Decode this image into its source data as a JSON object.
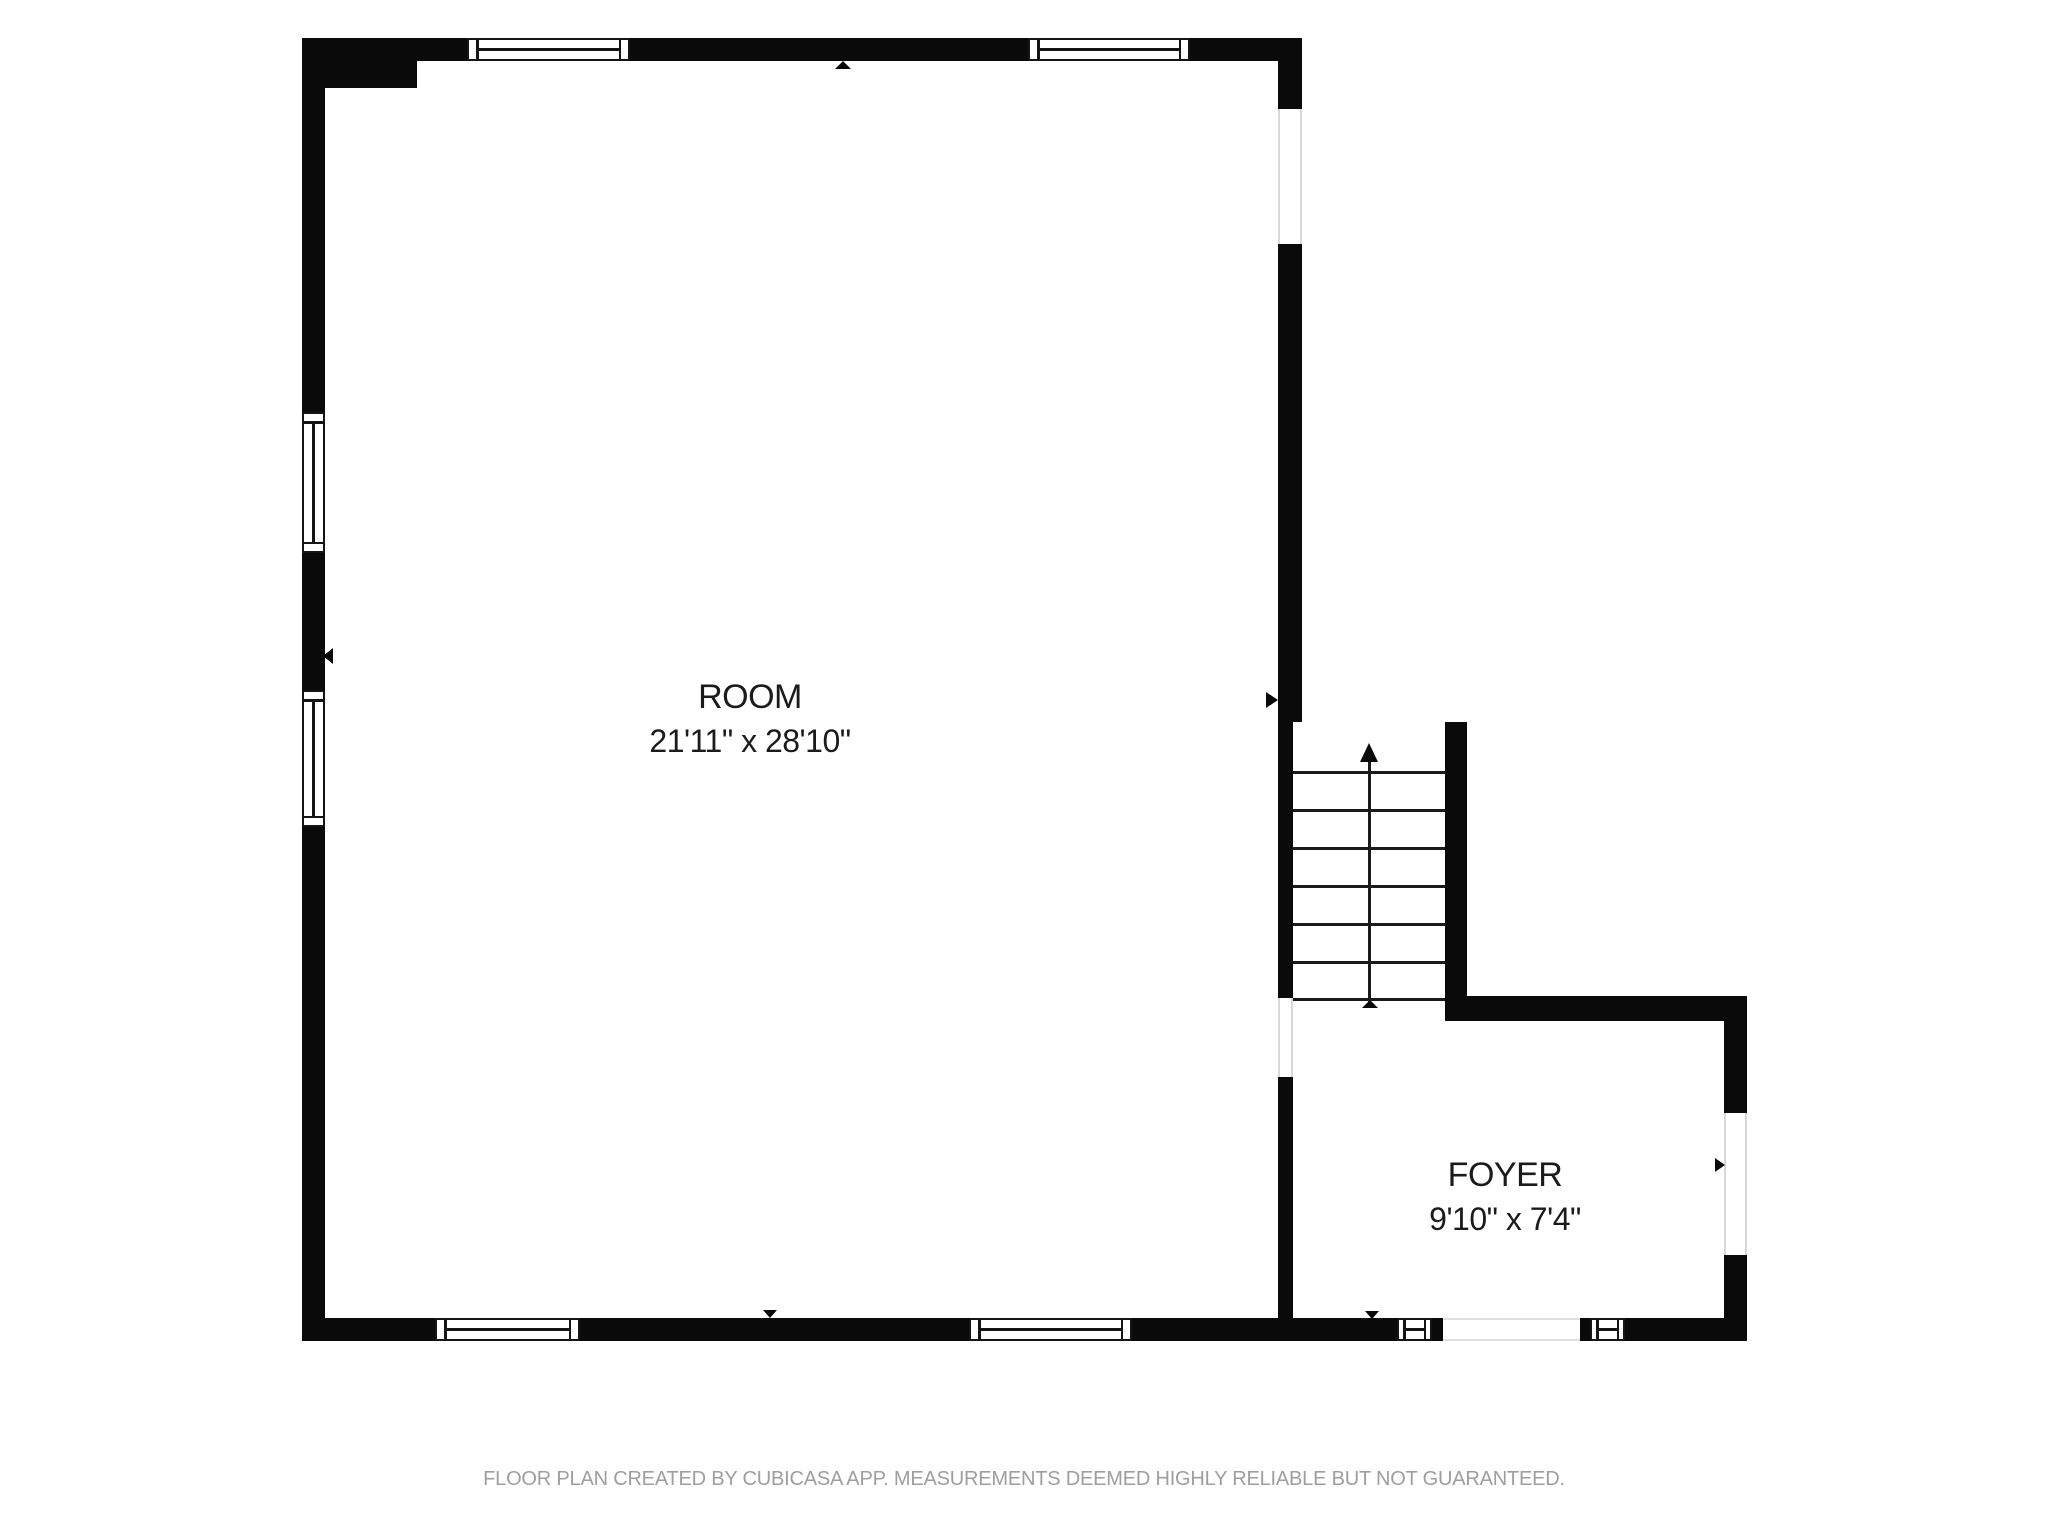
{
  "plan": {
    "rooms": [
      {
        "name": "ROOM",
        "dimensions": "21'11\" x 28'10\""
      },
      {
        "name": "FOYER",
        "dimensions": "9'10\" x 7'4\""
      }
    ],
    "stairs": {
      "direction": "up",
      "tread_count": 8
    },
    "footer": "FLOOR PLAN CREATED BY CUBICASA APP. MEASUREMENTS DEEMED HIGHLY RELIABLE BUT NOT GUARANTEED.",
    "colors": {
      "wall": "#0a0a0a",
      "label_text": "#1b1b1b",
      "footer_text": "#9e9e9e",
      "background": "#ffffff",
      "opening_edge": "#d8d8d8"
    }
  }
}
